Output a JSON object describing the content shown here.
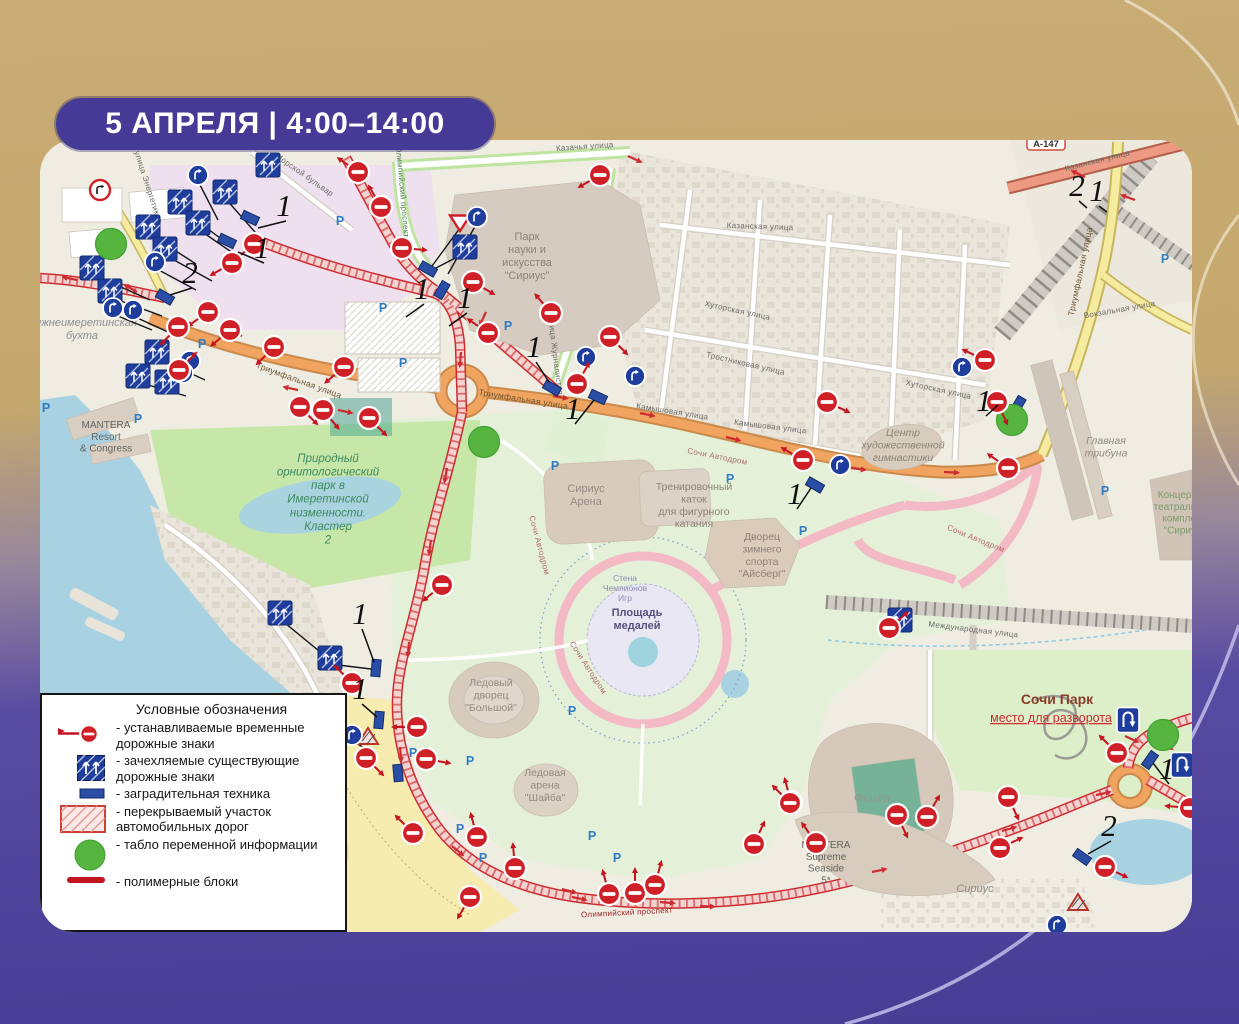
{
  "badge": {
    "text": "5 АПРЕЛЯ | 4:00–14:00"
  },
  "colors": {
    "badge_purple": "#453B96",
    "background_gold": "#C9AC74",
    "background_purple": "#463D94",
    "sign_red": "#CF1F27",
    "sign_blue": "#1E3D9C",
    "board_green": "#56B53F",
    "closed_road_red": "#CE2B31",
    "water_blue": "#A8D2E2",
    "road_orange": "#F1A45F"
  },
  "legend": {
    "title": "Условные обозначения",
    "items": [
      {
        "icon": "temporary-sign-icon",
        "label": "- устанавливаемые временные дорожные знаки"
      },
      {
        "icon": "covered-sign-icon",
        "label": "- зачехляемые существующие дорожные знаки"
      },
      {
        "icon": "barrier-icon",
        "label": "- заградительная техника"
      },
      {
        "icon": "closed-road-icon",
        "label": "- перекрываемый участок автомобильных дорог"
      },
      {
        "icon": "info-board-icon",
        "label": "- табло переменной информации"
      },
      {
        "icon": "polymer-block-icon",
        "label": "- полимерные блоки"
      }
    ]
  },
  "map": {
    "shield": {
      "text": "А-147",
      "x": 1046,
      "y": 143
    },
    "places": [
      [
        "Нижнеимеретинская\nбухта",
        82,
        326,
        11,
        "#8a8f94",
        "i"
      ],
      [
        "MANTERA\nResort\n& Congress",
        106,
        428,
        10,
        "#63635e",
        ""
      ],
      [
        "Природный\nорнитологический\nпарк в\nИмеретинской\nнизменности.\nКластер\n2",
        328,
        462,
        11.5,
        "#3e8a5f",
        "i"
      ],
      [
        "Парк\nнауки и\nискусства\n\"Сириус\"",
        527,
        240,
        11,
        "#8c8378",
        ""
      ],
      [
        "Сириус\nАрена",
        586,
        492,
        11,
        "#948a80",
        ""
      ],
      [
        "Тренировочный\nкаток\nдля фигурного\nкатания",
        694,
        490,
        10.5,
        "#8c8378",
        ""
      ],
      [
        "Дворец\nзимнего\nспорта\n\"Айсберг\"",
        762,
        540,
        10.5,
        "#8c8378",
        ""
      ],
      [
        "Стена\nЧемпионов\nИгр",
        625,
        581,
        8.5,
        "#8f8bb5",
        ""
      ],
      [
        "Площадь\nмедалей",
        637,
        616,
        11,
        "#55517d",
        "b"
      ],
      [
        "Центр\nхудожественной\nгимнастики",
        903,
        436,
        10.5,
        "#8c8378",
        "i"
      ],
      [
        "Главная\nтрибуна",
        1106,
        444,
        10.5,
        "#948a80",
        "i"
      ],
      [
        "Концертно-\nтеатральный\nкомплекс\n\"Сириус\"",
        1184,
        498,
        10,
        "#7d9a6d",
        ""
      ],
      [
        "Ледовый\nдворец\n\"Большой\"",
        491,
        686,
        10.5,
        "#948a80",
        ""
      ],
      [
        "Ледовая\nарена\n\"Шайба\"",
        545,
        776,
        10.5,
        "#948a80",
        ""
      ],
      [
        "Фишт",
        872,
        802,
        12,
        "#8f9a8f",
        "i"
      ],
      [
        "Сочи Парк",
        1057,
        704,
        14,
        "#8a3d2a",
        "b"
      ],
      [
        "место для разворота",
        1051,
        722,
        12.5,
        "#CE2B31",
        "u"
      ],
      [
        "MANTERA\nSupreme\nSeaside\n5*",
        826,
        848,
        10,
        "#63635e",
        ""
      ],
      [
        "Сириус",
        975,
        892,
        11,
        "#8d8d86",
        "i"
      ]
    ],
    "streets": [
      [
        "улица Энергетиков",
        146,
        188,
        72,
        8,
        ""
      ],
      [
        "Морской бульвар",
        303,
        177,
        35,
        8,
        ""
      ],
      [
        "Казачья улица",
        585,
        149,
        -4,
        8,
        ""
      ],
      [
        "Казанская улица",
        1098,
        163,
        -14,
        8,
        ""
      ],
      [
        "Казанская улица",
        760,
        229,
        2,
        8,
        ""
      ],
      [
        "Триумфальная улица",
        298,
        383,
        20,
        8.5,
        "#6d5430"
      ],
      [
        "Триумфальная улица",
        523,
        402,
        9,
        8.5,
        "#6d5430"
      ],
      [
        "Триумфальная улица",
        1083,
        272,
        -78,
        8.5,
        "#6d5430"
      ],
      [
        "Вокзальная улица",
        1120,
        312,
        -10,
        8,
        ""
      ],
      [
        "Олимпийский проспект",
        400,
        192,
        85,
        8,
        "#4c7e4c"
      ],
      [
        "Олимпийский проспект",
        627,
        915,
        -3,
        8,
        "#9b2323"
      ],
      [
        "улица Журналистов",
        553,
        356,
        83,
        8,
        ""
      ],
      [
        "Камышовая улица",
        672,
        414,
        9,
        8,
        ""
      ],
      [
        "Камышовая улица",
        770,
        429,
        7,
        8,
        ""
      ],
      [
        "Тростниковая улица",
        745,
        366,
        13,
        8,
        ""
      ],
      [
        "Хуторская улица",
        737,
        313,
        12,
        8,
        ""
      ],
      [
        "Хуторская улица",
        938,
        392,
        12,
        8,
        ""
      ],
      [
        "Международная улица",
        973,
        632,
        7,
        8,
        ""
      ],
      [
        "Сочи Автодром",
        717,
        459,
        11,
        8,
        "#b06a72"
      ],
      [
        "Сочи Автодром",
        537,
        546,
        75,
        8,
        "#b06a72"
      ],
      [
        "Сочи Автодром",
        586,
        669,
        57,
        8,
        "#b06a72"
      ],
      [
        "Сочи Автодром",
        975,
        541,
        22,
        8,
        "#b06a72"
      ]
    ],
    "parking_symbol": "P",
    "parking": [
      [
        340,
        225
      ],
      [
        383,
        312
      ],
      [
        403,
        367
      ],
      [
        202,
        348
      ],
      [
        138,
        423
      ],
      [
        46,
        412
      ],
      [
        555,
        470
      ],
      [
        730,
        483
      ],
      [
        803,
        535
      ],
      [
        572,
        715
      ],
      [
        470,
        765
      ],
      [
        413,
        757
      ],
      [
        460,
        833
      ],
      [
        483,
        862
      ],
      [
        592,
        840
      ],
      [
        617,
        862
      ],
      [
        1105,
        495
      ],
      [
        1165,
        263
      ],
      [
        508,
        330
      ]
    ],
    "markers": {
      "no_entry": [
        [
          358,
          172,
          215
        ],
        [
          381,
          207,
          240
        ],
        [
          600,
          175,
          150
        ],
        [
          402,
          248,
          5
        ],
        [
          473,
          282,
          30
        ],
        [
          488,
          333,
          215
        ],
        [
          551,
          313,
          230
        ],
        [
          610,
          337,
          45
        ],
        [
          577,
          384,
          300
        ],
        [
          254,
          244,
          140
        ],
        [
          232,
          263,
          150
        ],
        [
          208,
          312,
          145
        ],
        [
          178,
          327,
          135
        ],
        [
          230,
          330,
          140
        ],
        [
          274,
          347,
          135
        ],
        [
          344,
          367,
          140
        ],
        [
          300,
          407,
          45
        ],
        [
          323,
          410,
          50
        ],
        [
          369,
          418,
          45
        ],
        [
          179,
          370,
          315
        ],
        [
          442,
          585,
          140
        ],
        [
          352,
          683,
          225
        ],
        [
          366,
          758,
          45
        ],
        [
          417,
          727,
          180
        ],
        [
          426,
          759,
          10
        ],
        [
          413,
          833,
          225
        ],
        [
          477,
          837,
          255
        ],
        [
          515,
          868,
          265
        ],
        [
          470,
          897,
          120
        ],
        [
          609,
          894,
          255
        ],
        [
          635,
          893,
          270
        ],
        [
          655,
          885,
          285
        ],
        [
          754,
          844,
          295
        ],
        [
          791,
          802,
          255
        ],
        [
          816,
          843,
          235
        ],
        [
          790,
          803,
          225
        ],
        [
          897,
          815,
          65
        ],
        [
          927,
          817,
          300
        ],
        [
          1000,
          848,
          335
        ],
        [
          1008,
          797,
          65
        ],
        [
          1105,
          867,
          25
        ],
        [
          1117,
          753,
          225
        ],
        [
          1190,
          808,
          185
        ],
        [
          827,
          402,
          25
        ],
        [
          803,
          460,
          210
        ],
        [
          997,
          402,
          65
        ],
        [
          1008,
          468,
          215
        ],
        [
          889,
          628,
          320
        ],
        [
          985,
          360,
          205
        ]
      ],
      "covered_square": [
        [
          268,
          165
        ],
        [
          225,
          192
        ],
        [
          180,
          202
        ],
        [
          148,
          227
        ],
        [
          198,
          223
        ],
        [
          165,
          249
        ],
        [
          92,
          268
        ],
        [
          110,
          291
        ],
        [
          157,
          352
        ],
        [
          138,
          376
        ],
        [
          167,
          382
        ],
        [
          280,
          613
        ],
        [
          330,
          658
        ],
        [
          465,
          247
        ],
        [
          900,
          620
        ]
      ],
      "blue_circle": [
        [
          198,
          175
        ],
        [
          155,
          262
        ],
        [
          113,
          308
        ],
        [
          133,
          310
        ],
        [
          190,
          361
        ],
        [
          183,
          373
        ],
        [
          477,
          217
        ],
        [
          586,
          357
        ],
        [
          635,
          376
        ],
        [
          840,
          465
        ],
        [
          962,
          367
        ],
        [
          1057,
          925
        ],
        [
          352,
          735
        ]
      ],
      "barrier": [
        [
          250,
          218,
          25
        ],
        [
          227,
          241,
          25
        ],
        [
          165,
          297,
          30
        ],
        [
          428,
          269,
          30
        ],
        [
          442,
          290,
          120
        ],
        [
          552,
          388,
          30
        ],
        [
          598,
          397,
          25
        ],
        [
          376,
          668,
          95
        ],
        [
          379,
          720,
          95
        ],
        [
          815,
          485,
          30
        ],
        [
          1018,
          405,
          120
        ],
        [
          398,
          773,
          85
        ],
        [
          1082,
          857,
          35
        ],
        [
          1150,
          760,
          125
        ]
      ],
      "info_board": [
        [
          111,
          244
        ],
        [
          484,
          442
        ],
        [
          1012,
          420
        ],
        [
          1163,
          735
        ]
      ],
      "u_turn": [
        [
          1128,
          720
        ],
        [
          1182,
          765
        ]
      ],
      "no_turn": [
        [
          100,
          190
        ]
      ],
      "give_way": [
        [
          460,
          222
        ]
      ],
      "covered_triangle": [
        [
          368,
          737
        ],
        [
          1078,
          903
        ]
      ],
      "numbers": [
        [
          "1",
          284,
          216,
          258,
          228
        ],
        [
          "1",
          262,
          258,
          238,
          252
        ],
        [
          "2",
          190,
          283,
          170,
          295
        ],
        [
          "1",
          422,
          299,
          406,
          317
        ],
        [
          "1",
          465,
          308,
          449,
          326
        ],
        [
          "1",
          534,
          357,
          549,
          382
        ],
        [
          "1",
          573,
          419,
          594,
          400
        ],
        [
          "1",
          795,
          504,
          811,
          488
        ],
        [
          "1",
          984,
          411,
          998,
          405
        ],
        [
          "1",
          360,
          624,
          374,
          662
        ],
        [
          "1",
          360,
          699,
          377,
          717
        ],
        [
          "1",
          1167,
          779,
          1153,
          763
        ],
        [
          "2",
          1109,
          836,
          1088,
          854
        ],
        [
          "2",
          1077,
          196,
          1087,
          208
        ],
        [
          "1",
          1097,
          201,
          1107,
          212
        ]
      ],
      "red_arrows": [
        [
          628,
          156,
          25
        ],
        [
          1085,
          177,
          205
        ],
        [
          1135,
          200,
          200
        ],
        [
          486,
          312,
          115
        ],
        [
          461,
          352,
          95
        ],
        [
          553,
          396,
          10
        ],
        [
          640,
          413,
          12
        ],
        [
          726,
          437,
          14
        ],
        [
          851,
          468,
          8
        ],
        [
          944,
          472,
          3
        ],
        [
          447,
          468,
          100
        ],
        [
          431,
          540,
          98
        ],
        [
          409,
          642,
          95
        ],
        [
          400,
          747,
          85
        ],
        [
          452,
          846,
          40
        ],
        [
          562,
          889,
          15
        ],
        [
          700,
          906,
          3
        ],
        [
          872,
          872,
          -12
        ],
        [
          1002,
          831,
          -16
        ],
        [
          1096,
          795,
          -12
        ],
        [
          1160,
          742,
          30
        ],
        [
          298,
          390,
          192
        ],
        [
          338,
          410,
          12
        ],
        [
          242,
          336,
          200
        ],
        [
          212,
          317,
          205
        ],
        [
          137,
          292,
          210
        ],
        [
          77,
          280,
          192
        ],
        [
          572,
          897,
          12
        ],
        [
          660,
          902,
          5
        ],
        [
          1125,
          736,
          25
        ]
      ],
      "black_leaders": [
        [
          225,
          198,
          262,
          240
        ],
        [
          180,
          208,
          228,
          244
        ],
        [
          198,
          229,
          243,
          260
        ],
        [
          148,
          233,
          196,
          264
        ],
        [
          165,
          255,
          212,
          281
        ],
        [
          92,
          274,
          150,
          300
        ],
        [
          110,
          297,
          162,
          316
        ],
        [
          157,
          358,
          205,
          380
        ],
        [
          138,
          382,
          186,
          396
        ],
        [
          280,
          619,
          330,
          660
        ],
        [
          330,
          664,
          371,
          669
        ],
        [
          465,
          253,
          434,
          269
        ],
        [
          460,
          228,
          432,
          266
        ],
        [
          477,
          223,
          448,
          274
        ],
        [
          198,
          181,
          218,
          220
        ],
        [
          155,
          268,
          196,
          290
        ],
        [
          113,
          314,
          152,
          330
        ],
        [
          133,
          316,
          168,
          332
        ],
        [
          352,
          741,
          372,
          752
        ]
      ]
    }
  }
}
